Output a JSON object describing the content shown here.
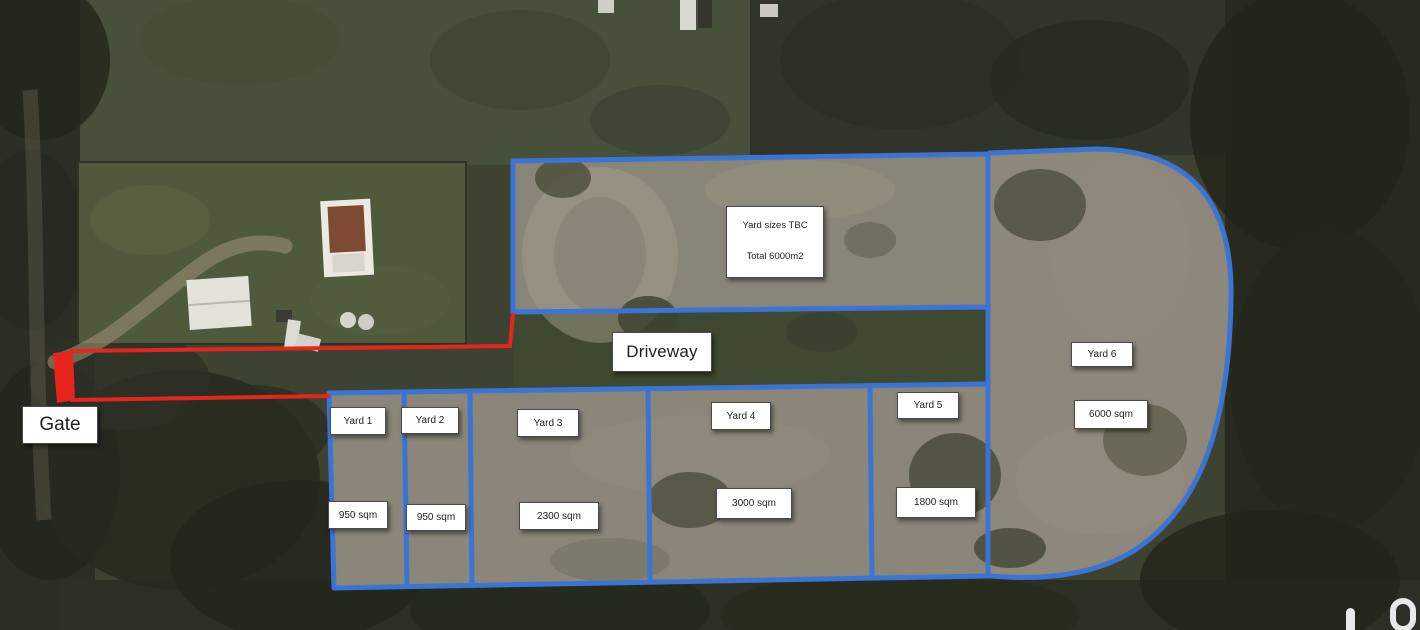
{
  "colors": {
    "boundary_blue": "#3a74d4",
    "route_red": "#e6261c",
    "label_background": "#ffffff",
    "label_text": "#1e1e1e"
  },
  "labels": {
    "gate": "Gate",
    "driveway": "Driveway",
    "note_line1": "Yard sizes TBC",
    "note_line2": "Total 6000m2"
  },
  "yards": [
    {
      "name": "Yard 1",
      "size": "950 sqm"
    },
    {
      "name": "Yard 2",
      "size": "950 sqm"
    },
    {
      "name": "Yard 3",
      "size": "2300 sqm"
    },
    {
      "name": "Yard 4",
      "size": "3000 sqm"
    },
    {
      "name": "Yard 5",
      "size": "1800 sqm"
    },
    {
      "name": "Yard 6",
      "size": "6000 sqm"
    }
  ],
  "map_controls": [
    {
      "icon": "person-marker-icon"
    },
    {
      "icon": "compass-ring-icon"
    }
  ]
}
